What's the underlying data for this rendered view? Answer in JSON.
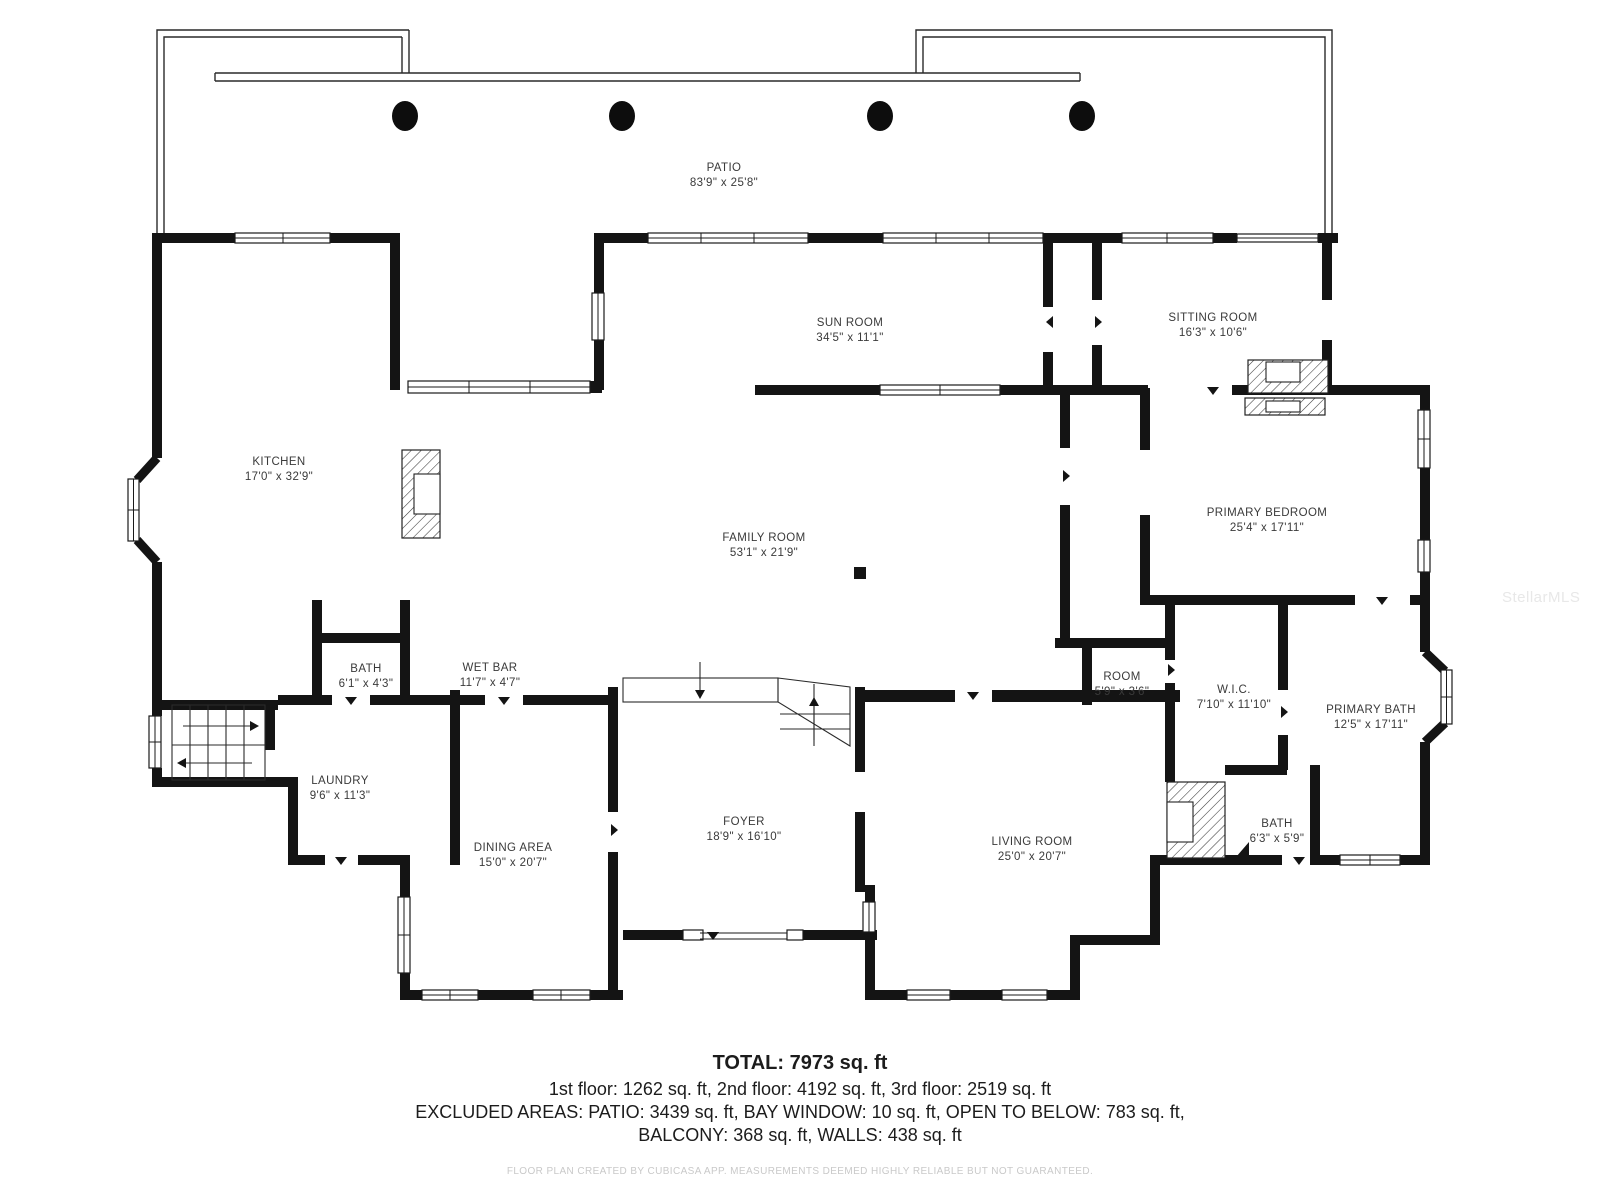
{
  "plan": {
    "rooms": [
      {
        "id": "patio",
        "name": "PATIO",
        "dims": "83'9\" x 25'8\""
      },
      {
        "id": "sun-room",
        "name": "SUN ROOM",
        "dims": "34'5\" x 11'1\""
      },
      {
        "id": "sitting-room",
        "name": "SITTING ROOM",
        "dims": "16'3\" x 10'6\""
      },
      {
        "id": "kitchen",
        "name": "KITCHEN",
        "dims": "17'0\" x 32'9\""
      },
      {
        "id": "family-room",
        "name": "FAMILY ROOM",
        "dims": "53'1\" x 21'9\""
      },
      {
        "id": "primary-bedroom",
        "name": "PRIMARY BEDROOM",
        "dims": "25'4\" x 17'11\""
      },
      {
        "id": "bath-upper",
        "name": "BATH",
        "dims": "6'1\" x 4'3\""
      },
      {
        "id": "wet-bar",
        "name": "WET BAR",
        "dims": "11'7\" x 4'7\""
      },
      {
        "id": "room-small",
        "name": "ROOM",
        "dims": "5'9\" x 3'6\""
      },
      {
        "id": "wic",
        "name": "W.I.C.",
        "dims": "7'10\" x 11'10\""
      },
      {
        "id": "primary-bath",
        "name": "PRIMARY BATH",
        "dims": "12'5\" x 17'11\""
      },
      {
        "id": "laundry",
        "name": "LAUNDRY",
        "dims": "9'6\" x 11'3\""
      },
      {
        "id": "dining-area",
        "name": "DINING AREA",
        "dims": "15'0\" x 20'7\""
      },
      {
        "id": "foyer",
        "name": "FOYER",
        "dims": "18'9\" x 16'10\""
      },
      {
        "id": "living-room",
        "name": "LIVING ROOM",
        "dims": "25'0\" x 20'7\""
      },
      {
        "id": "bath-lower",
        "name": "BATH",
        "dims": "6'3\" x 5'9\""
      }
    ],
    "summary": {
      "total": "TOTAL: 7973 sq. ft",
      "floors": "1st floor: 1262 sq. ft, 2nd floor: 4192 sq. ft, 3rd floor: 2519 sq. ft",
      "excluded_1": "EXCLUDED AREAS: PATIO: 3439 sq. ft, BAY WINDOW: 10 sq. ft, OPEN TO BELOW: 783 sq. ft,",
      "excluded_2": "BALCONY: 368 sq. ft, WALLS: 438 sq. ft"
    },
    "footer_note": "FLOOR PLAN CREATED BY CUBICASA APP. MEASUREMENTS DEEMED HIGHLY RELIABLE BUT NOT GUARANTEED.",
    "watermark": "StellarMLS",
    "colors": {
      "wall": "#141414",
      "label": "#3a3a3a",
      "footer_text": "#c9c9c9",
      "watermark": "#e8e8e8"
    }
  }
}
